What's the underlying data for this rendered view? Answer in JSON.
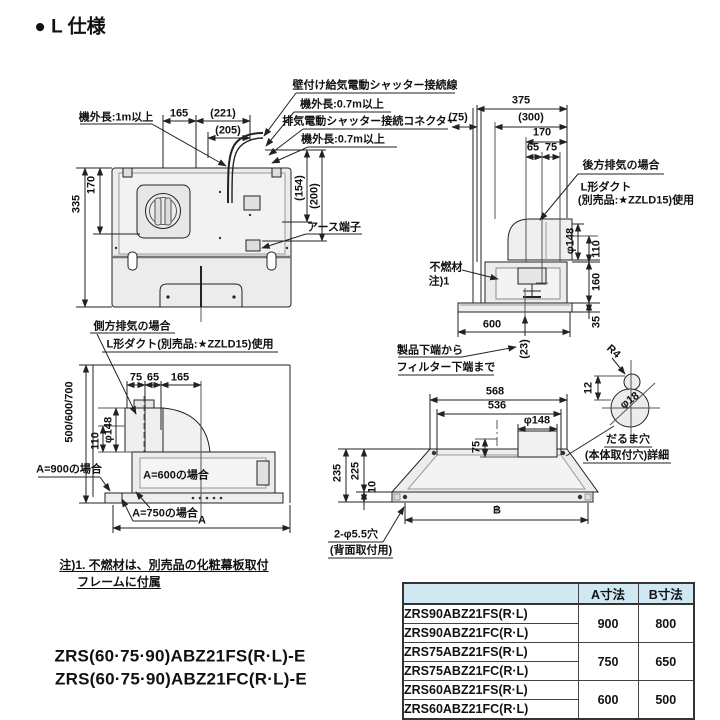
{
  "title": "● L 仕様",
  "callouts": {
    "l1": "壁付け給気電動シャッター接続線",
    "l2": "機外長:0.7m以上",
    "l3": "排気電動シャッター接続コネクター",
    "l4": "機外長:0.7m以上"
  },
  "front": {
    "cord": "機外長:1m以上",
    "d165": "165",
    "d221": "(221)",
    "d205": "(205)",
    "d170": "170",
    "d335": "335",
    "d154": "(154)",
    "d200": "(200)",
    "earth": "アース端子"
  },
  "side": {
    "d375": "375",
    "d75p": "(75)",
    "d300": "(300)",
    "d170": "170",
    "d65": "65",
    "d75": "75",
    "rear1": "後方排気の場合",
    "rear2": "L形ダクト",
    "rear3": "(別売品:★ZZLD15)使用",
    "phi148": "φ148",
    "d110": "110",
    "d160": "160",
    "d35": "35",
    "d600": "600",
    "d23": "(23)",
    "nc1": "不燃材",
    "nc2": "注)1",
    "pb1": "製品下端から",
    "pb2": "フィルター下端まで"
  },
  "left": {
    "side1": "側方排気の場合",
    "side2": "L形ダクト(別売品:★ZZLD15)使用",
    "d75": "75",
    "d65": "65",
    "d165": "165",
    "dh": "500/600/700",
    "phi148": "φ148",
    "d110": "110",
    "a900": "A=900の場合",
    "a600": "A=600の場合",
    "a750": "A=750の場合",
    "dA": "A"
  },
  "bottom": {
    "d568": "568",
    "d536": "536",
    "phi148": "φ148",
    "d75": "75",
    "d235": "235",
    "d225": "225",
    "d10": "10",
    "dB": "B",
    "hole1": "2-φ5.5穴",
    "hole2": "(背面取付用)",
    "r4": "R4",
    "d12": "12",
    "phi18": "φ18",
    "daruma1": "だるま穴",
    "daruma2": "(本体取付穴)詳細"
  },
  "notes": {
    "n1": "注)1. 不燃材は、別売品の化粧幕板取付",
    "n2": "フレームに付属"
  },
  "models": {
    "m1": "ZRS(60·75·90)ABZ21FS(R·L)-E",
    "m2": "ZRS(60·75·90)ABZ21FC(R·L)-E"
  },
  "table": {
    "header_bg": "#cfe8f2",
    "headers": {
      "model": "",
      "a": "A寸法",
      "b": "B寸法"
    },
    "rows": [
      {
        "model": "ZRS90ABZ21FS(R·L)"
      },
      {
        "model": "ZRS90ABZ21FC(R·L)"
      },
      {
        "model": "ZRS75ABZ21FS(R·L)"
      },
      {
        "model": "ZRS75ABZ21FC(R·L)"
      },
      {
        "model": "ZRS60ABZ21FS(R·L)"
      },
      {
        "model": "ZRS60ABZ21FC(R·L)"
      }
    ],
    "groups": [
      {
        "a": "900",
        "b": "800"
      },
      {
        "a": "750",
        "b": "650"
      },
      {
        "a": "600",
        "b": "500"
      }
    ]
  }
}
